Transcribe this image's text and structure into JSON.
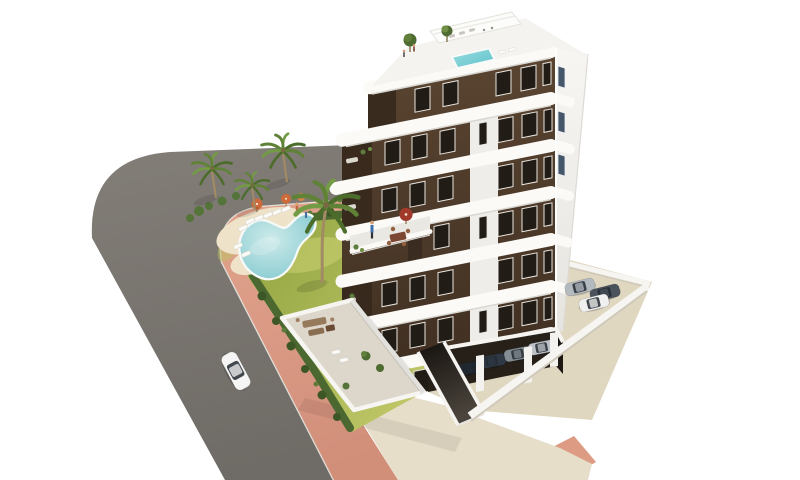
{
  "scene": {
    "type": "architectural-3d-render-aerial",
    "description": "Aerial 3D rendering of a modern 7-storey white apartment building with dark brown window bands and rounded white balcony slabs, rooftop terrace with plunge pool and pergola, landscaped corner garden with free-form swimming pool, sun loungers and palm trees, pink pavement along a curved grey street with one white car, and a walled residents' parking area with covered and open parking spaces.",
    "background": "#ffffff"
  },
  "palette": {
    "bg": "#ffffff",
    "road_light": "#837e78",
    "road_dark": "#6f6b66",
    "curb": "#edece6",
    "sidewalk_light": "#e2a48e",
    "sidewalk_dark": "#d18f7a",
    "sidewalk_patch": "#dd9b84",
    "apron": "#e7deca",
    "parking_floor": "#e0d7c0",
    "wall_white": "#f6f5f1",
    "wall_shadow": "#cfc9bb",
    "grass_light": "#c4ca6b",
    "grass_dark": "#8fa33f",
    "grass_patch": "#ccd172",
    "hedge": "#4c6831",
    "hedge_dark": "#3d5626",
    "hedge_light": "#5d7c3b",
    "deck": "#eee2c8",
    "pool_light": "#cdeaea",
    "pool_deep": "#82c9cf",
    "pool_rim": "#f7faf8",
    "lounger": "#fafaf7",
    "umbrella_orange": "#cd6b3a",
    "umbrella_red": "#a23a2b",
    "skin": "#d8a078",
    "person_blue": "#3e6fae",
    "trunk": "#a18a64",
    "palm_dark": "#4c6c2c",
    "palm_mid": "#5f8236",
    "palm_light": "#739b45",
    "bush": "#55743a",
    "facade_light": "#5a4431",
    "facade_dark": "#3f2f21",
    "recess": "#36281c",
    "window": "#221c16",
    "window_frame": "#e9e6df",
    "window_blue": "#45566b",
    "building_white": "#fbfaf7",
    "face_light": "#f7f6f3",
    "face_shade": "#e6e4df",
    "slab_shadow": "#d9d7d2",
    "pier": "#f6f5f2",
    "roof_deck": "#f4f3ef",
    "roofpool_light": "#9adde0",
    "roofpool_deep": "#5fc2ca",
    "terrace_floor": "#ddd7cb",
    "terrace_floor2": "#eae8e3",
    "void": "#262019",
    "ramp_top": "#14100c",
    "ramp_bottom": "#4a443c",
    "car_glass": "#252a31",
    "car_white": "#f4f5f4",
    "car_silver": "#bcc2c7",
    "car_gray": "#848c94",
    "car_slate": "#4a525c",
    "car_dark": "#2f3945",
    "car_black": "#20262e",
    "car_silver2": "#b3bac0",
    "car_offwhite": "#eff0ef",
    "furniture_brown": "#7c4834",
    "sofa": "#967a5c",
    "planter": "#3a2c20"
  },
  "objects": {
    "building": {
      "floors": 7,
      "facade": "white slabs with rounded balcony corners over dark brown window bands",
      "features": [
        "rooftop terrace",
        "rooftop plunge pool",
        "pergola",
        "mid-level terrace with red parasol",
        "covered parking at ground level",
        "basement ramp"
      ]
    },
    "garden": {
      "palm_trees": 6,
      "hedge_along_pavement": true,
      "lawn": true
    },
    "pool": {
      "shape": "free-form",
      "loungers": 8,
      "parasols": 3
    },
    "street": {
      "surface": "asphalt",
      "pavement_color": "pink",
      "cars_driving": 1
    },
    "parking": {
      "covered_cars": 4,
      "open_cars": 3,
      "perimeter_wall": "white",
      "ramp": true
    },
    "people_visible": 7
  }
}
